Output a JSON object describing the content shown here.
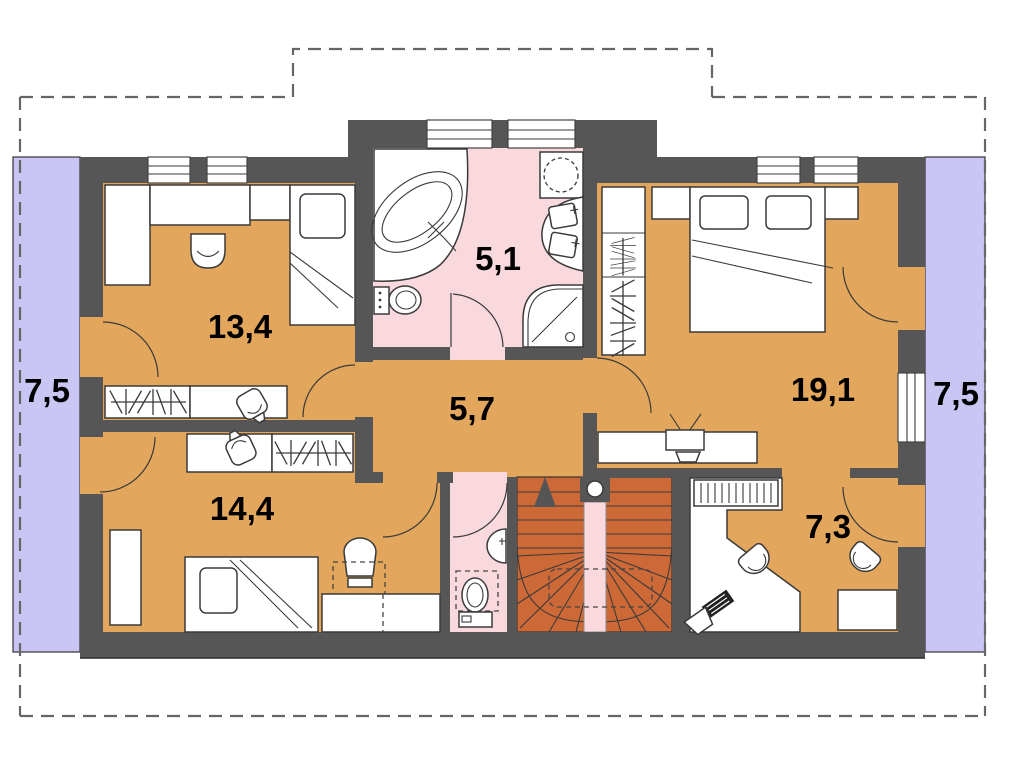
{
  "plan": {
    "type": "architectural-floor-plan",
    "level": "attic-floor",
    "rooms": [
      {
        "name": "balcony-left",
        "area": "7,5"
      },
      {
        "name": "room-top-left",
        "area": "13,4"
      },
      {
        "name": "bathroom",
        "area": "5,1"
      },
      {
        "name": "hall",
        "area": "5,7"
      },
      {
        "name": "bedroom",
        "area": "19,1"
      },
      {
        "name": "balcony-right",
        "area": "7,5"
      },
      {
        "name": "room-bottom-left",
        "area": "14,4"
      },
      {
        "name": "study",
        "area": "7,3"
      }
    ],
    "colors": {
      "room_floor": "#E2A65C",
      "wet_room_floor": "#F9D9DD",
      "balcony": "#C9C6F3",
      "stairs": "#CD6937",
      "wall": "#565656",
      "furniture_line": "#3A3A3A",
      "roof_outline_dash": "#666666"
    },
    "fixtures": [
      "corner-bathtub",
      "washing-machine",
      "double-washbasin",
      "corner-shower",
      "toilet",
      "hand-basin",
      "double-bed",
      "single-bed",
      "wardrobe-with-hangers",
      "desk",
      "desk-chair",
      "armchair",
      "bucket-chair",
      "radiator",
      "tv-set",
      "computer",
      "stair-up-arrow",
      "newel-post"
    ]
  }
}
